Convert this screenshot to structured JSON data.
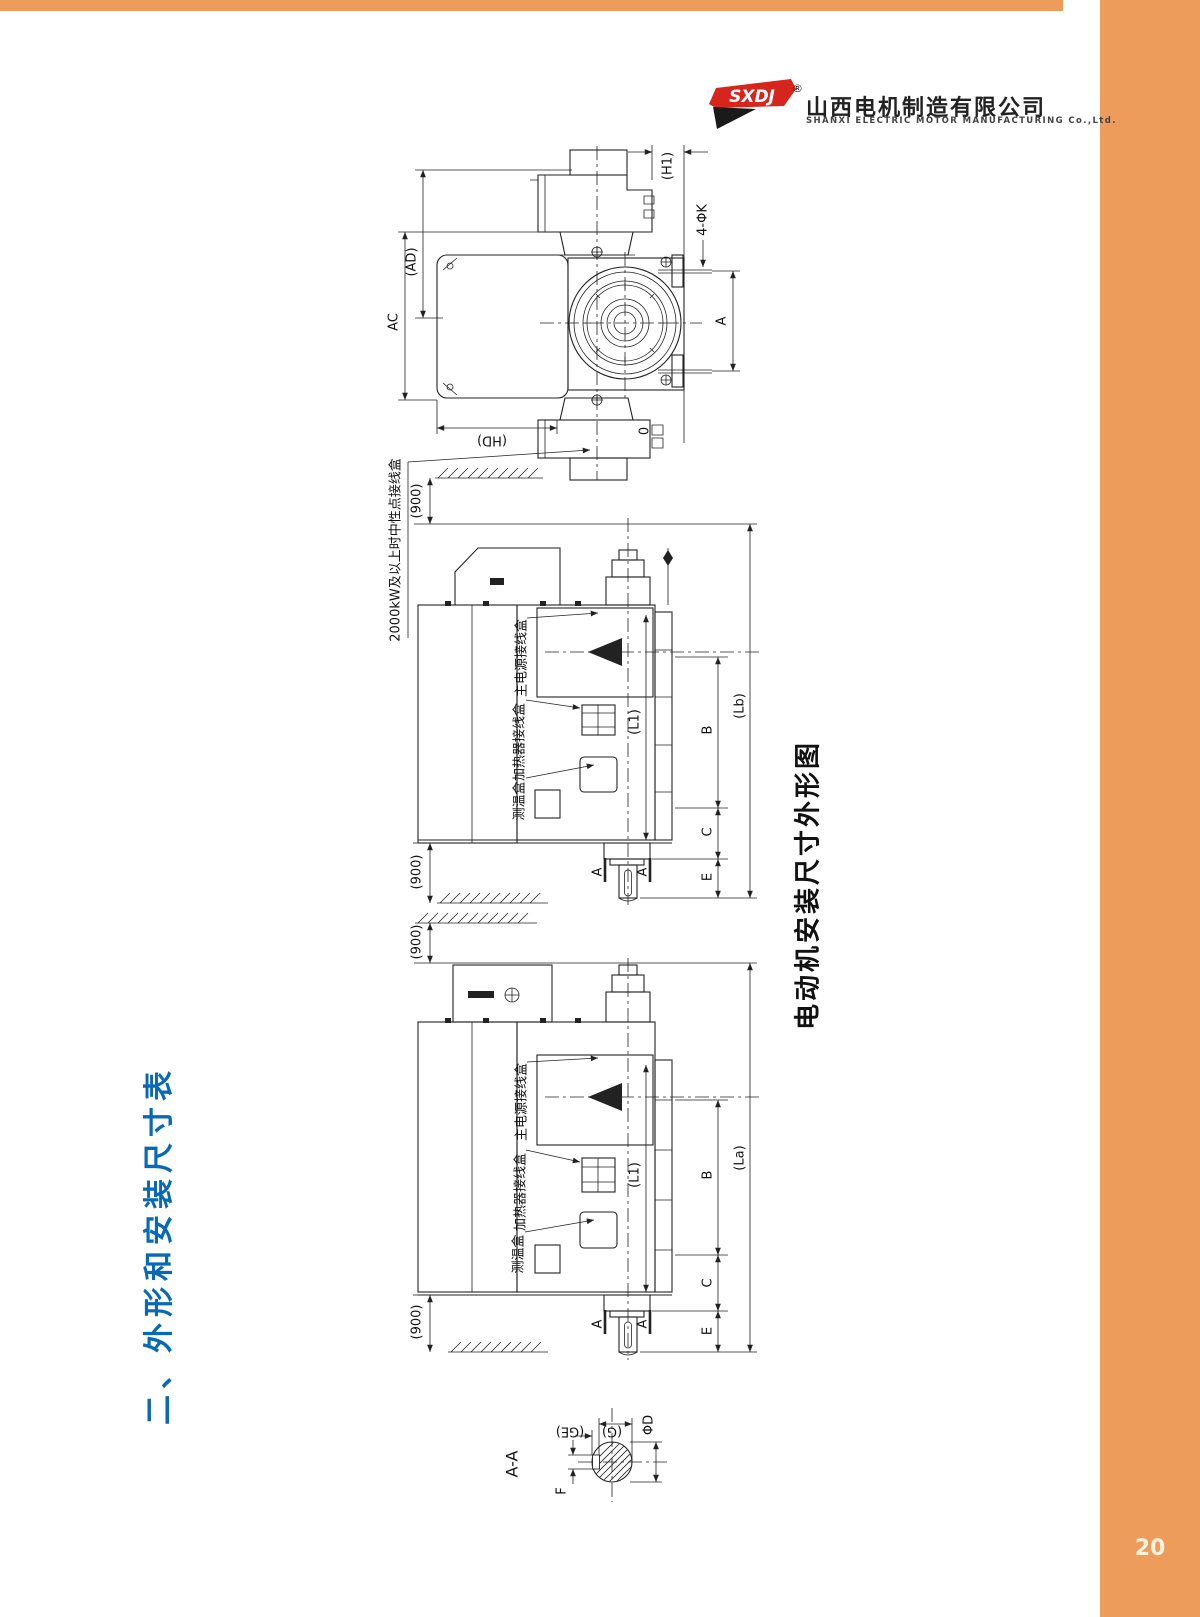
{
  "page": {
    "number": "20"
  },
  "brand": {
    "logo": "SXDJ",
    "registered": "®",
    "company_cn": "山西电机制造有限公司",
    "company_en": "SHANXI ELECTRIC MOTOR MANUFACTURING Co.,Ltd."
  },
  "section_title": "二、外形和安装尺寸表",
  "figure_caption": "电动机安装尺寸外形图",
  "notes": {
    "neutral_box": "2000kW及以上时中性点接线盒"
  },
  "boxes": {
    "main_power": "主电源接线盒",
    "heater": "加热器接线盒",
    "temp": "测温盒"
  },
  "dims": {
    "clearance": "(900)",
    "end_view": {
      "h1": "(H1)",
      "k_holes": "4-ΦK",
      "ad": "(AD)",
      "ac": "AC",
      "a": "A",
      "hd": "(HD)",
      "zero": "0"
    },
    "side_top": {
      "l1": "(L1)",
      "b": "B",
      "c": "C",
      "e": "E",
      "lb": "(Lb)",
      "a": "A"
    },
    "side_bottom": {
      "l1": "(L1)",
      "b": "B",
      "c": "C",
      "e": "E",
      "la": "(La)",
      "a": "A"
    },
    "section": {
      "title": "A-A",
      "ge": "(GE)",
      "g": "(G)",
      "d": "ΦD",
      "f": "F"
    }
  },
  "colors": {
    "accent_orange": "#ED9C5C",
    "title_blue": "#0A69B4",
    "line": "#222222",
    "page_number": "#FBF2DC",
    "brand_red": "#D6251D"
  }
}
